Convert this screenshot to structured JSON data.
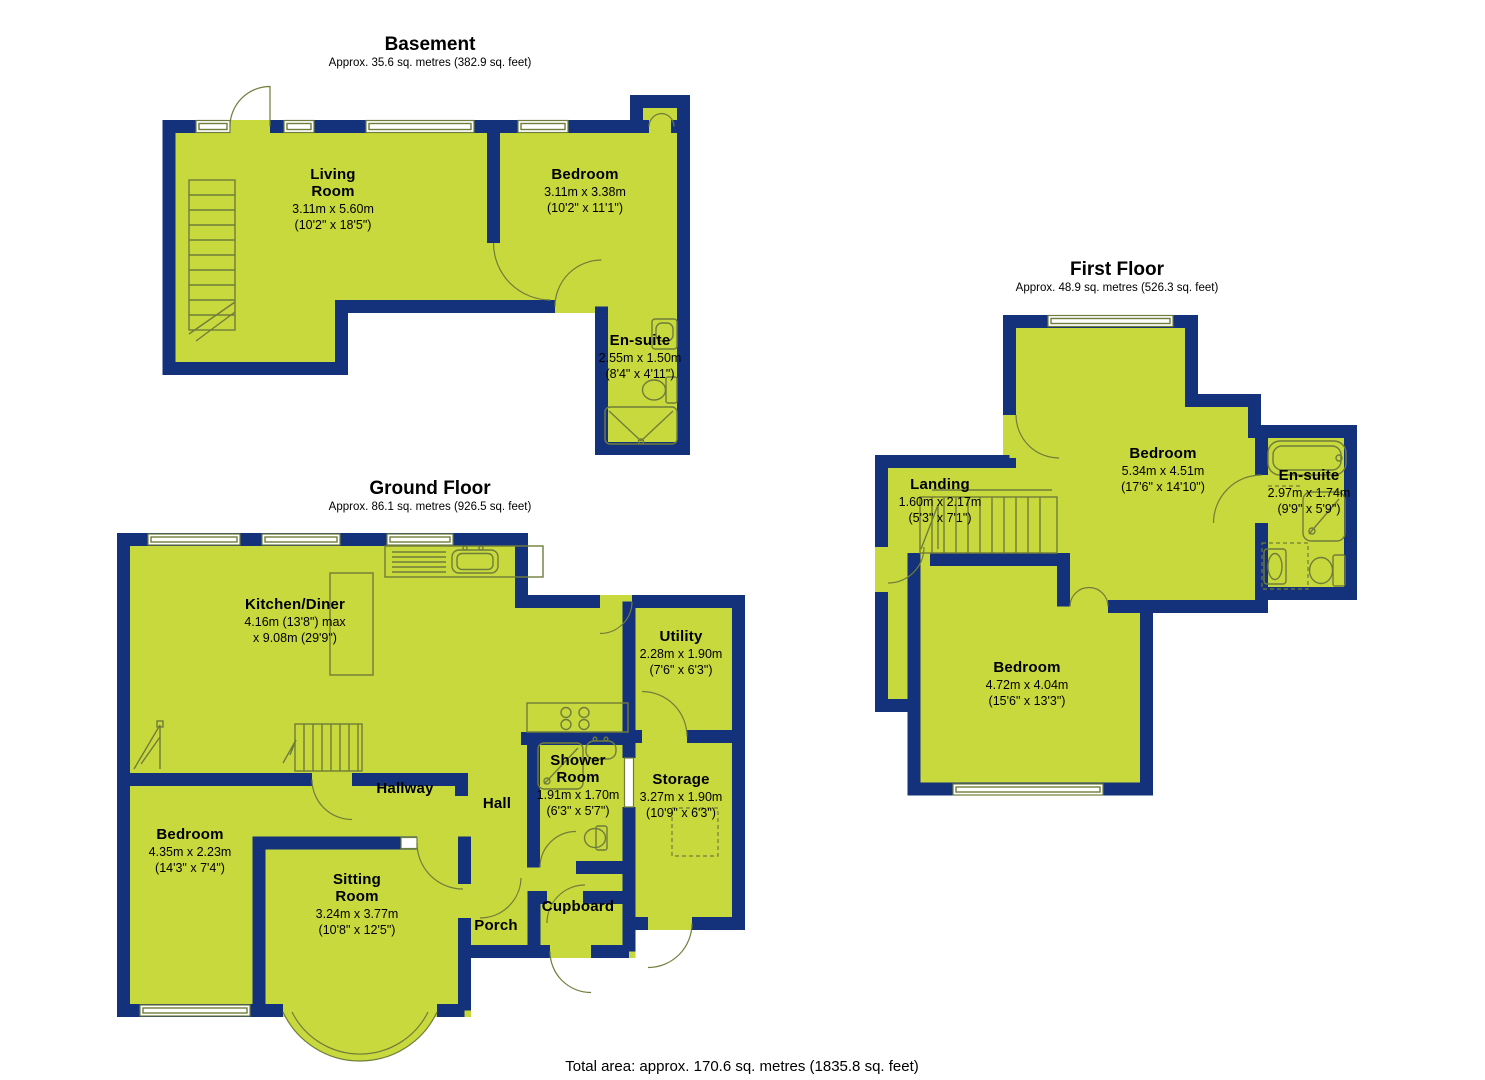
{
  "colors": {
    "background": "#ffffff",
    "room_fill": "#c8d93d",
    "wall": "#14317b",
    "fixture_line": "#6f7d3a",
    "window_fill": "#ffffff",
    "text": "#000000"
  },
  "floors": [
    {
      "title": "Basement",
      "subtitle": "Approx. 35.6 sq. metres (382.9 sq. feet)",
      "rooms": [
        {
          "name": "Living\nRoom",
          "dims_m": "3.11m x 5.60m",
          "dims_ft": "(10'2\" x 18'5\")"
        },
        {
          "name": "Bedroom",
          "dims_m": "3.11m x 3.38m",
          "dims_ft": "(10'2\" x 11'1\")"
        },
        {
          "name": "En-suite",
          "dims_m": "2.55m x 1.50m",
          "dims_ft": "(8'4\" x 4'11\")"
        }
      ]
    },
    {
      "title": "Ground Floor",
      "subtitle": "Approx. 86.1 sq. metres (926.5 sq. feet)",
      "rooms": [
        {
          "name": "Kitchen/Diner",
          "dims_m": "4.16m (13'8\") max",
          "dims_ft": "x 9.08m (29'9\")"
        },
        {
          "name": "Utility",
          "dims_m": "2.28m x 1.90m",
          "dims_ft": "(7'6\" x 6'3\")"
        },
        {
          "name": "Shower\nRoom",
          "dims_m": "1.91m x 1.70m",
          "dims_ft": "(6'3\" x 5'7\")"
        },
        {
          "name": "Storage",
          "dims_m": "3.27m x 1.90m",
          "dims_ft": "(10'9\" x 6'3\")"
        },
        {
          "name": "Hallway"
        },
        {
          "name": "Hall"
        },
        {
          "name": "Bedroom",
          "dims_m": "4.35m x 2.23m",
          "dims_ft": "(14'3\" x 7'4\")"
        },
        {
          "name": "Sitting\nRoom",
          "dims_m": "3.24m x 3.77m",
          "dims_ft": "(10'8\" x 12'5\")"
        },
        {
          "name": "Porch"
        },
        {
          "name": "Cupboard"
        }
      ]
    },
    {
      "title": "First Floor",
      "subtitle": "Approx. 48.9 sq. metres (526.3 sq. feet)",
      "rooms": [
        {
          "name": "Landing",
          "dims_m": "1.60m x 2.17m",
          "dims_ft": "(5'3\" x 7'1\")"
        },
        {
          "name": "Bedroom",
          "dims_m": "5.34m x 4.51m",
          "dims_ft": "(17'6\" x 14'10\")"
        },
        {
          "name": "En-suite",
          "dims_m": "2.97m x 1.74m",
          "dims_ft": "(9'9\" x 5'9\")"
        },
        {
          "name": "Bedroom",
          "dims_m": "4.72m x 4.04m",
          "dims_ft": "(15'6\" x 13'3\")"
        }
      ]
    }
  ],
  "footer": {
    "total_area": "Total area: approx. 170.6 sq. metres (1835.8 sq. feet)"
  }
}
